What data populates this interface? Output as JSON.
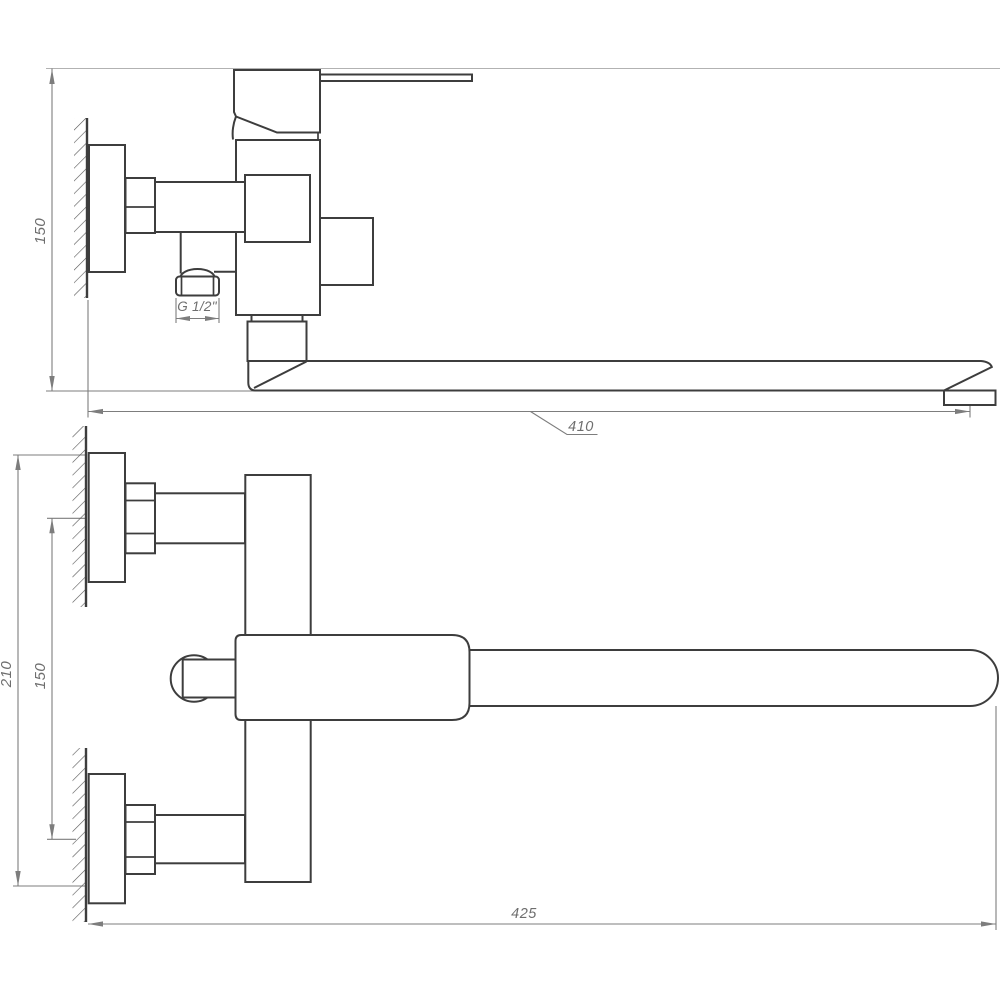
{
  "drawing": {
    "background": "#ffffff",
    "outline_color": "#3d3d3d",
    "dimension_color": "#7d7d7d",
    "side_view": {
      "labels": {
        "height": "150",
        "spout_reach": "410",
        "thread_size": "G 1/2\""
      }
    },
    "plan_view": {
      "labels": {
        "overall_depth": "210",
        "mount_centers": "150",
        "overall_length": "425"
      }
    }
  }
}
